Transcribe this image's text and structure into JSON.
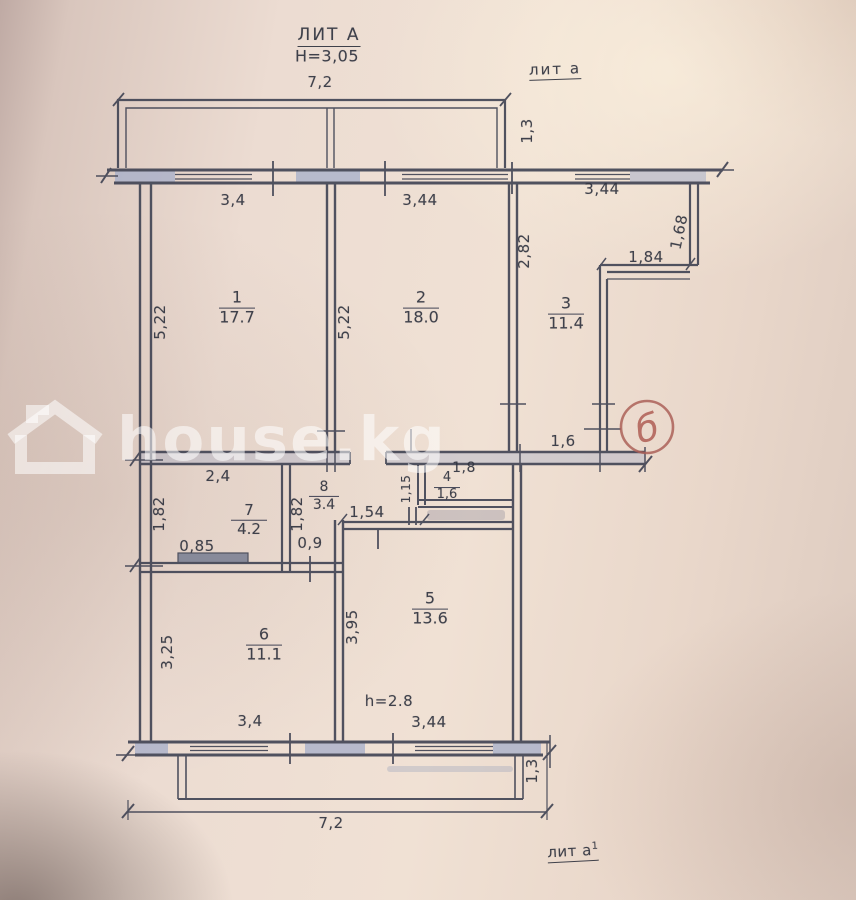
{
  "annotations": {
    "lit_a": "ЛИТ А",
    "building_height": "H=3,05",
    "lit_a_small": "лит а",
    "lit_a1_small": "лит а",
    "lit_a1_sup": "1",
    "ceiling_note": "h=2.8",
    "mark_b": "б"
  },
  "watermark": {
    "text": "house.kg",
    "icon": "house-icon"
  },
  "rooms": [
    {
      "number": "1",
      "area": "17.7"
    },
    {
      "number": "2",
      "area": "18.0"
    },
    {
      "number": "3",
      "area": "11.4"
    },
    {
      "number": "4",
      "area": "1,6"
    },
    {
      "number": "5",
      "area": "13.6"
    },
    {
      "number": "6",
      "area": "11.1"
    },
    {
      "number": "7",
      "area": "4.2"
    },
    {
      "number": "8",
      "area": "3.4"
    }
  ],
  "dimensions": {
    "balcony_top_width": "7,2",
    "balcony_top_depth": "1,3",
    "window1_width": "3,4",
    "window2_width": "3,44",
    "window3_width": "3,44",
    "room1_depth": "5,22",
    "room2_depth": "5,22",
    "room3_left_depth": "2,82",
    "room3_right_depth": "1,68",
    "room3_niche_width": "1,84",
    "hall_opening": "1,6",
    "hall_width": "2,4",
    "wc_width": "1,8",
    "wc_depth": "1,15",
    "room7_depth": "1,82",
    "room8_depth": "1,82",
    "passage_width": "1,54",
    "closet_width": "0,85",
    "door_width": "0,9",
    "room5_depth": "3,95",
    "room6_depth": "3,25",
    "window4_width": "3,4",
    "window5_width": "3,44",
    "balcony_bottom_width": "7,2",
    "balcony_bottom_depth": "1,3"
  },
  "colors": {
    "ink": "#3e4152",
    "wall_highlight": "#a3adc9",
    "red_mark": "#a5544b",
    "paper": "#ecdcd2"
  }
}
